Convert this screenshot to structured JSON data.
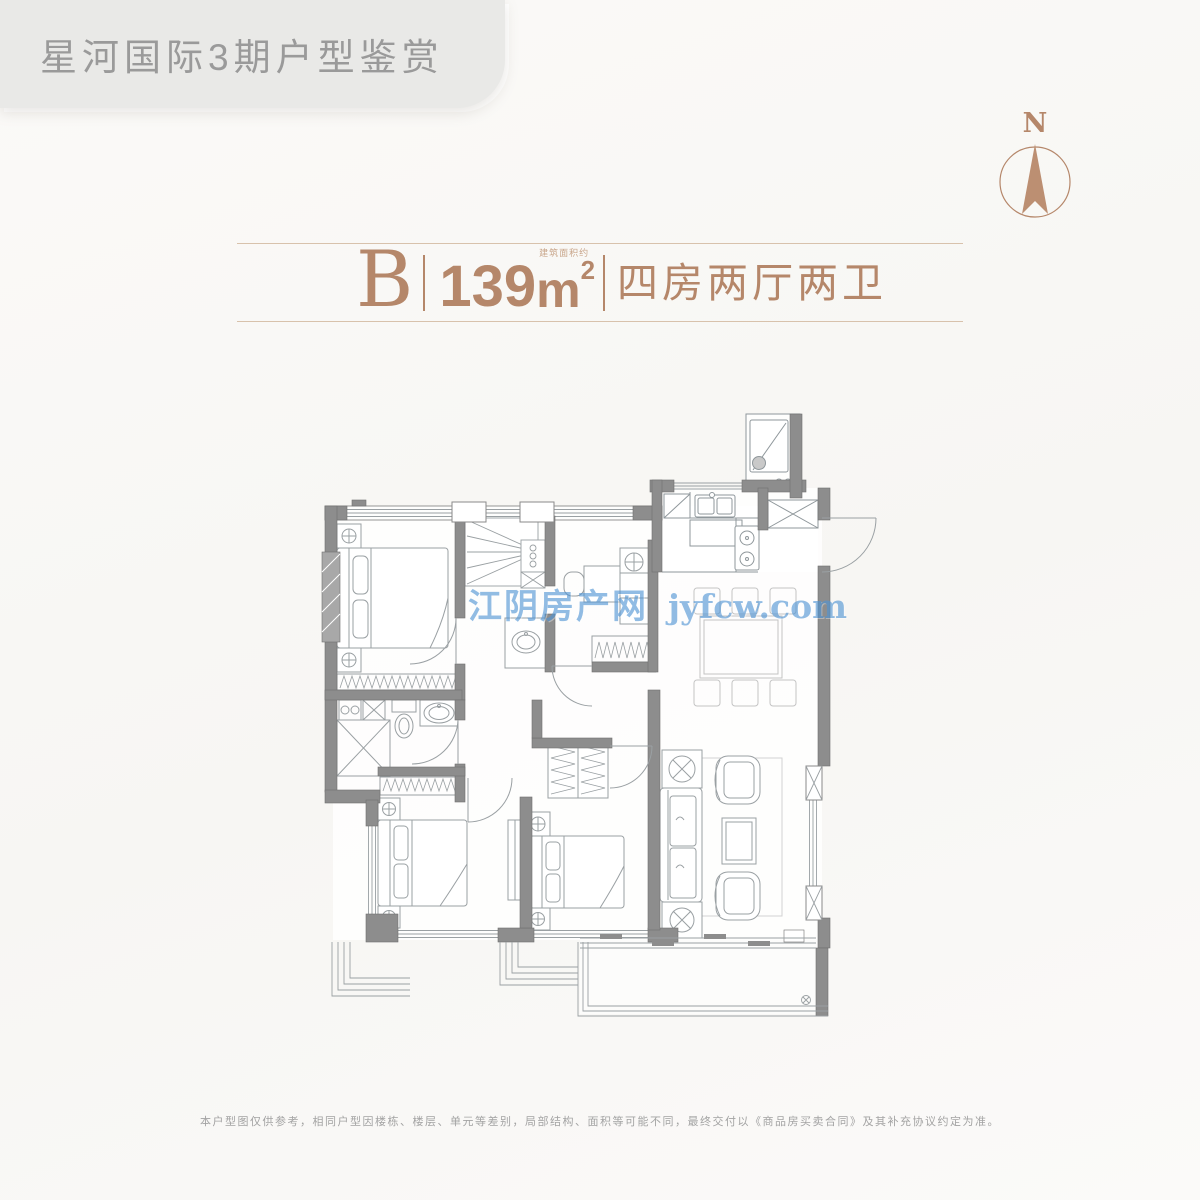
{
  "header": {
    "title": "星河国际3期户型鉴赏"
  },
  "compass": {
    "label": "N"
  },
  "unit": {
    "type_label": "B",
    "area_value": "139",
    "area_unit": "m",
    "area_sup": "2",
    "area_note": "建筑面积约",
    "layout_label": "四房两厅两卫"
  },
  "watermark": {
    "site_name": "江阴房产网",
    "site_url": "jyfcw.com"
  },
  "footer": {
    "disclaimer": "本户型图仅供参考，相同户型因楼栋、楼层、单元等差别，局部结构、面积等可能不同，最终交付以《商品房买卖合同》及其补充协议约定为准。"
  },
  "colors": {
    "accent": "#b5876a",
    "banner_bg": "#e9e9e7",
    "banner_text": "#9a9a9a",
    "watermark": "#4f94d4",
    "wall": "#8d8d8d",
    "line": "#9aa0a3"
  }
}
